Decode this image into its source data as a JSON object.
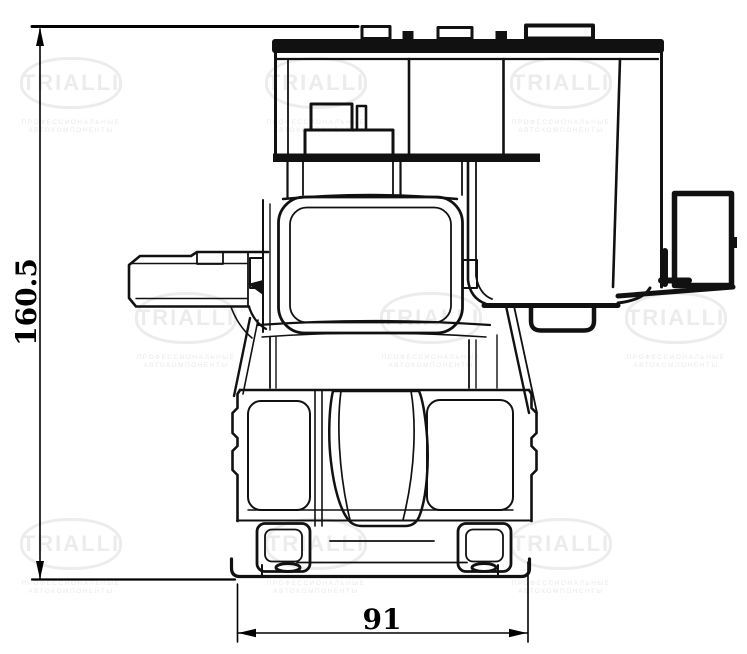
{
  "drawing": {
    "title": "brake-caliper-front-view-technical-drawing",
    "dimensions": {
      "height": {
        "value": "160.5"
      },
      "width": {
        "value": "91"
      }
    },
    "watermark": {
      "brand": "TRIALLI",
      "tagline_line1": "ПРОФЕССИОНАЛЬНЫЕ",
      "tagline_line2": "АВТОКОМПОНЕНТЫ"
    },
    "colors": {
      "line": "#111111",
      "dimension_line": "#000000",
      "background": "#ffffff",
      "watermark": "#ececec"
    }
  }
}
